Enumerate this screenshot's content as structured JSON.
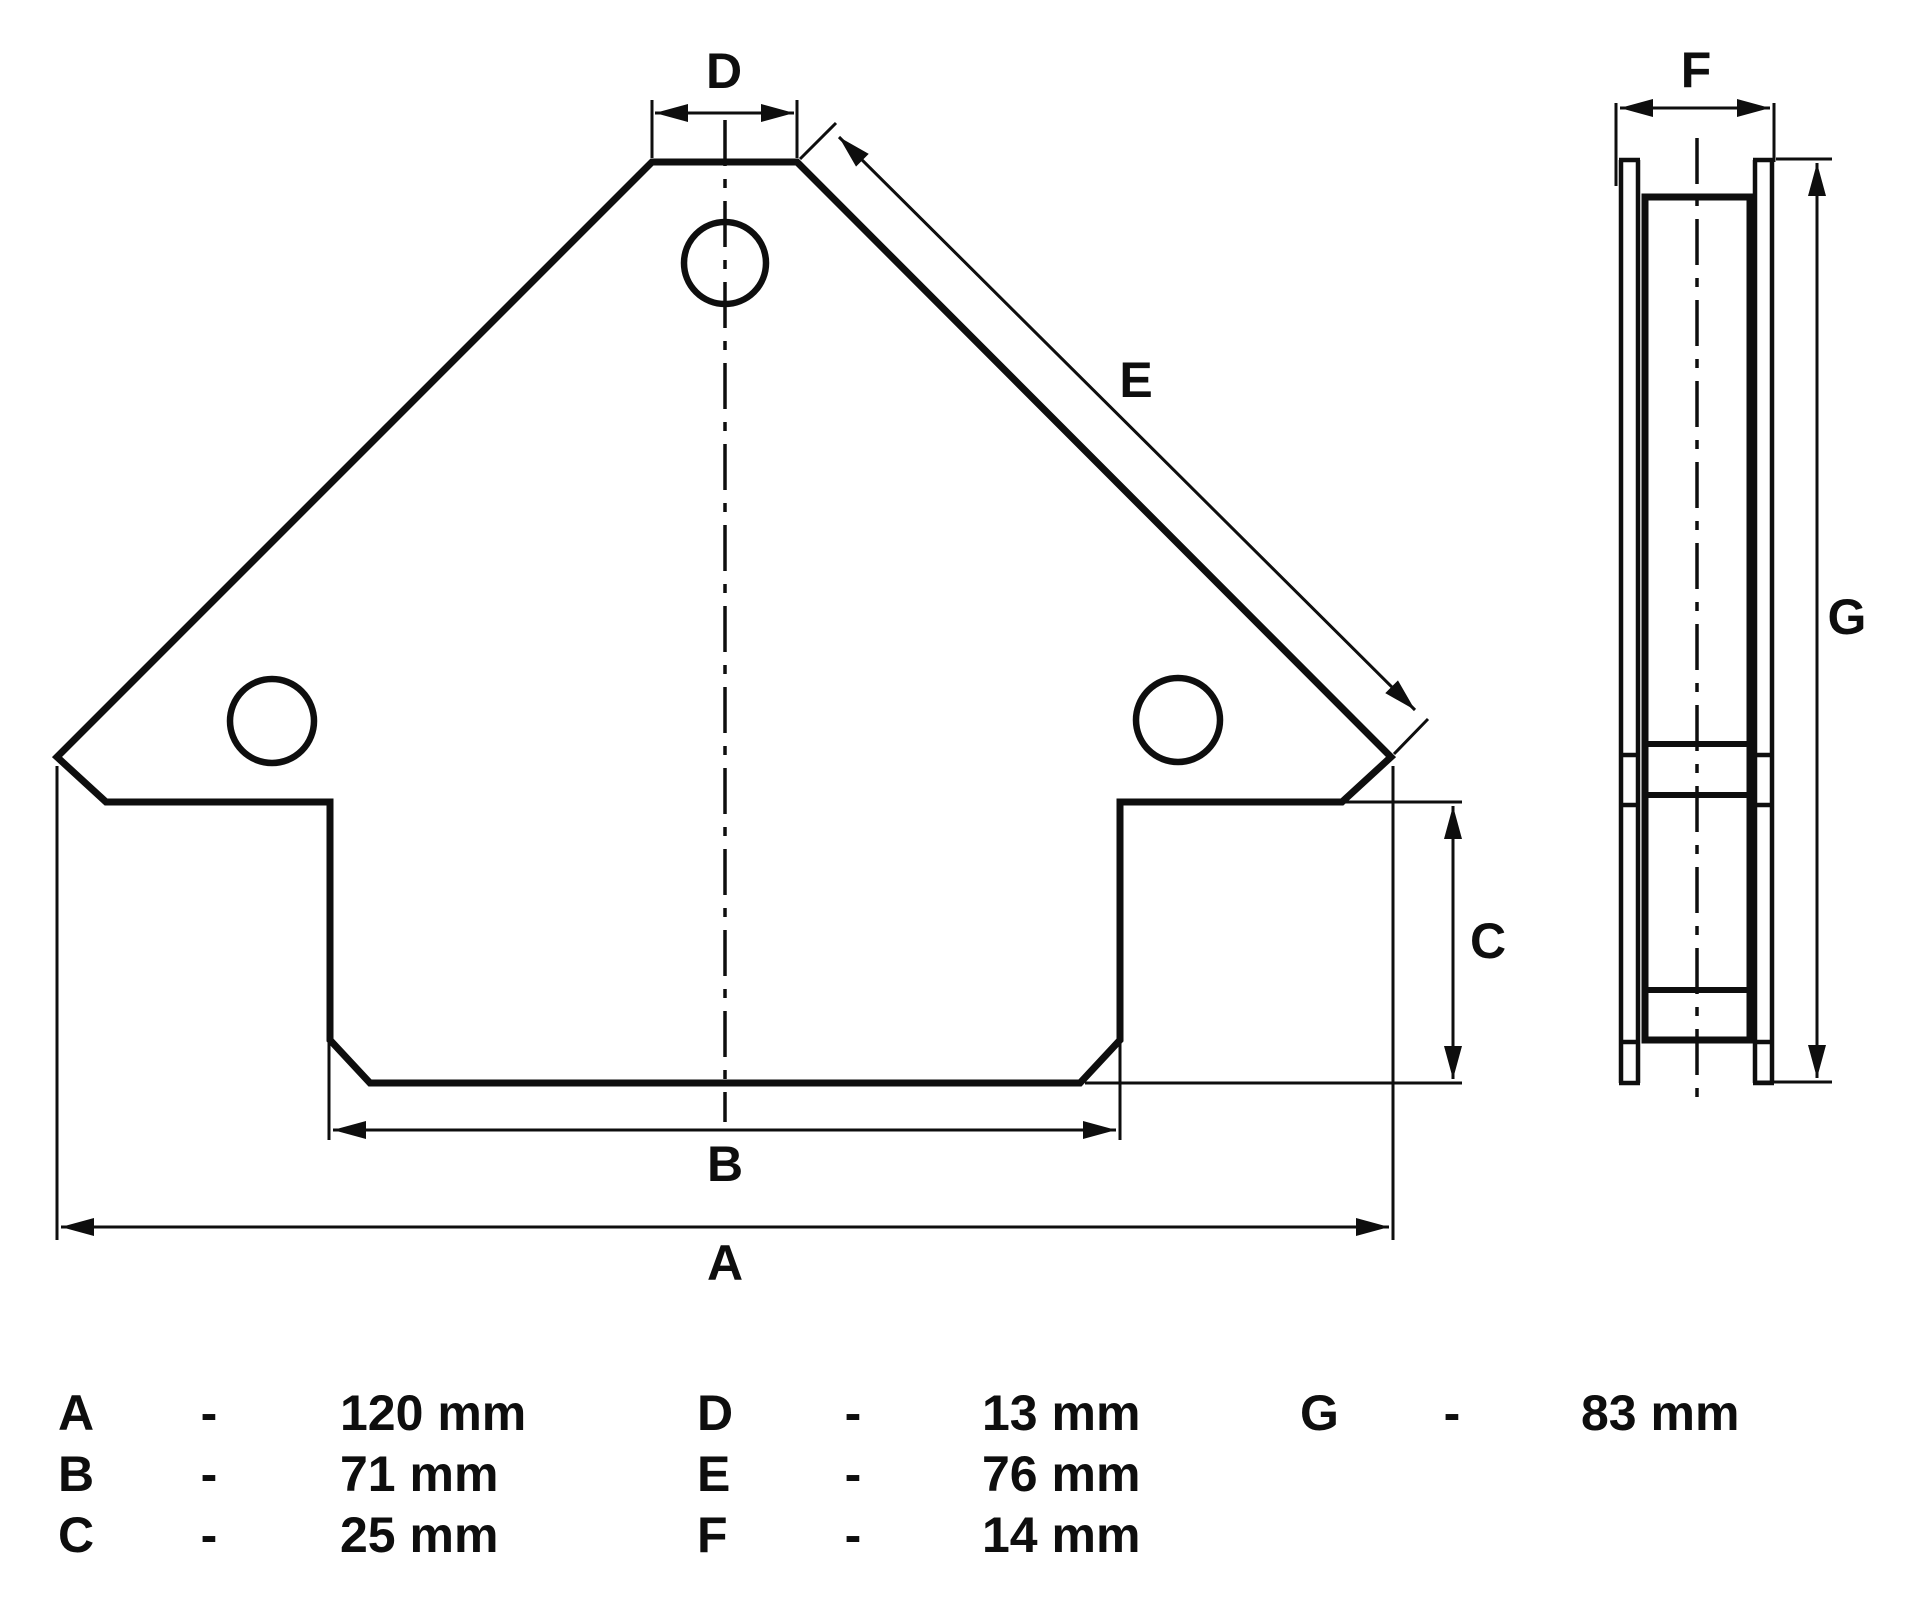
{
  "drawing_type": "technical-dimension-diagram",
  "colors": {
    "ink": "#0e0e0e",
    "background": "#ffffff"
  },
  "dims": {
    "A": {
      "letter": "A",
      "value": "120 mm"
    },
    "B": {
      "letter": "B",
      "value": "71 mm"
    },
    "C": {
      "letter": "C",
      "value": "25 mm"
    },
    "D": {
      "letter": "D",
      "value": "13 mm"
    },
    "E": {
      "letter": "E",
      "value": "76 mm"
    },
    "F": {
      "letter": "F",
      "value": "14 mm"
    },
    "G": {
      "letter": "G",
      "value": "83 mm"
    }
  },
  "legend": {
    "separator": "-"
  }
}
